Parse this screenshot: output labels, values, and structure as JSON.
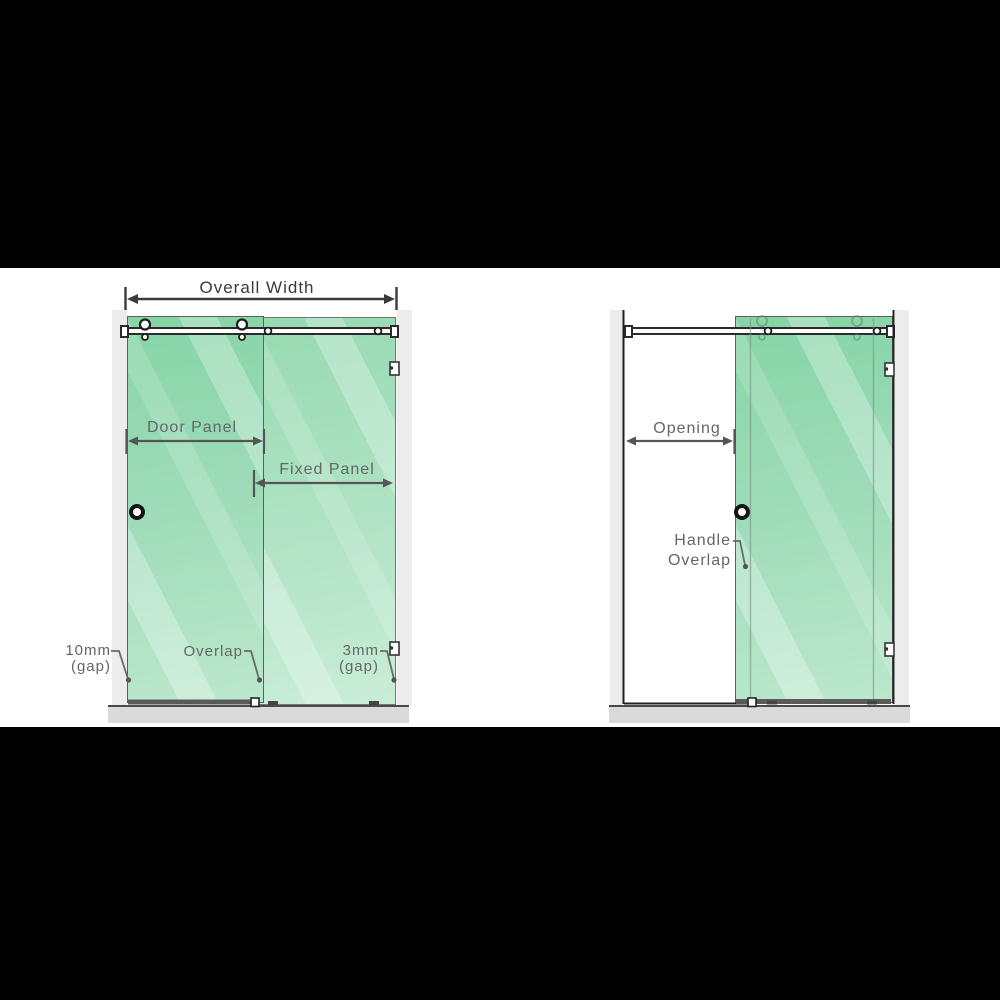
{
  "scene": {
    "description": "Sliding shower screen measurement diagrams, front views (closed and open door)",
    "background_color": "#000000",
    "canvas_color": "#ffffff"
  },
  "colors": {
    "glass_green": "#a2ddbc",
    "glass_green_light": "#b0e3c5",
    "wall_grey": "#ececec",
    "floor_grey": "#dadada",
    "frame_dark": "#2b2b2b",
    "label_grey": "#666666",
    "dimension_dark": "#3a3a3a"
  },
  "left_diagram": {
    "name": "closed-door-view",
    "labels": {
      "overall_width": "Overall Width",
      "door_panel": "Door Panel",
      "fixed_panel": "Fixed Panel",
      "overlap": "Overlap",
      "gap_left_line1": "10mm",
      "gap_left_line2": "(gap)",
      "gap_right_line1": "3mm",
      "gap_right_line2": "(gap)"
    }
  },
  "right_diagram": {
    "name": "open-door-view",
    "labels": {
      "opening": "Opening",
      "handle_overlap_line1": "Handle",
      "handle_overlap_line2": "Overlap"
    }
  }
}
